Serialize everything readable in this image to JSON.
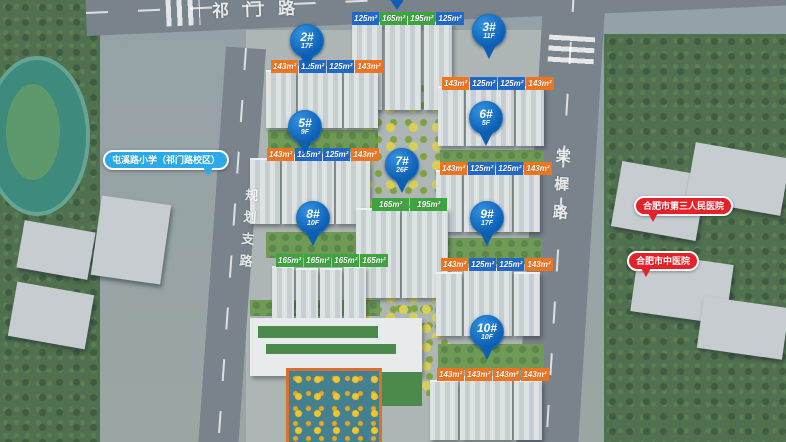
{
  "colors": {
    "pin": "#0d5fb4",
    "tag_blue": "#2268c8",
    "tag_orange": "#ef7420",
    "tag_green": "#3fa33f",
    "school_bubble": "#2ba9e8",
    "hospital_bubble": "#e62129"
  },
  "roads": {
    "top": "祁门路",
    "left": "规划支路",
    "right": "棠樨路"
  },
  "pois": {
    "school": {
      "label": "屯溪路小学（祁门路校区）"
    },
    "hospital1": {
      "label": "合肥市第三人民医院"
    },
    "hospital2": {
      "label": "合肥市中医院"
    }
  },
  "pins": [
    {
      "label": "2#",
      "floors": "17F"
    },
    {
      "label": "3#",
      "floors": "11F"
    },
    {
      "label": "5#",
      "floors": "9F"
    },
    {
      "label": "6#",
      "floors": "5F"
    },
    {
      "label": "7#",
      "floors": "26F"
    },
    {
      "label": "8#",
      "floors": "10F"
    },
    {
      "label": "9#",
      "floors": "17F"
    },
    {
      "label": "10#",
      "floors": "10F"
    }
  ],
  "unit_rows": [
    {
      "building": "1#",
      "tags": [
        {
          "v": "125m²",
          "c": "blue"
        },
        {
          "v": "165m²",
          "c": "green"
        },
        {
          "v": "195m²",
          "c": "green"
        },
        {
          "v": "125m²",
          "c": "blue"
        }
      ]
    },
    {
      "building": "2#",
      "tags": [
        {
          "v": "143m²",
          "c": "orange"
        },
        {
          "v": "125m²",
          "c": "blue"
        },
        {
          "v": "125m²",
          "c": "blue"
        },
        {
          "v": "143m²",
          "c": "orange"
        }
      ]
    },
    {
      "building": "3#",
      "tags": [
        {
          "v": "143m²",
          "c": "orange"
        },
        {
          "v": "125m²",
          "c": "blue"
        },
        {
          "v": "125m²",
          "c": "blue"
        },
        {
          "v": "143m²",
          "c": "orange"
        }
      ]
    },
    {
      "building": "5#",
      "tags": [
        {
          "v": "143m²",
          "c": "orange"
        },
        {
          "v": "125m²",
          "c": "blue"
        },
        {
          "v": "125m²",
          "c": "blue"
        },
        {
          "v": "143m²",
          "c": "orange"
        }
      ]
    },
    {
      "building": "6#",
      "tags": [
        {
          "v": "143m²",
          "c": "orange"
        },
        {
          "v": "125m²",
          "c": "blue"
        },
        {
          "v": "125m²",
          "c": "blue"
        },
        {
          "v": "143m²",
          "c": "orange"
        }
      ]
    },
    {
      "building": "7#",
      "tags": [
        {
          "v": "165m²",
          "c": "green"
        },
        {
          "v": "195m²",
          "c": "green"
        }
      ]
    },
    {
      "building": "8#",
      "tags": [
        {
          "v": "165m²",
          "c": "green"
        },
        {
          "v": "165m²",
          "c": "green"
        },
        {
          "v": "165m²",
          "c": "green"
        },
        {
          "v": "165m²",
          "c": "green"
        }
      ]
    },
    {
      "building": "9#",
      "tags": [
        {
          "v": "143m²",
          "c": "orange"
        },
        {
          "v": "125m²",
          "c": "blue"
        },
        {
          "v": "125m²",
          "c": "blue"
        },
        {
          "v": "143m²",
          "c": "orange"
        }
      ]
    },
    {
      "building": "10#",
      "tags": [
        {
          "v": "143m²",
          "c": "orange"
        },
        {
          "v": "143m²",
          "c": "orange"
        },
        {
          "v": "143m²",
          "c": "orange"
        },
        {
          "v": "143m²",
          "c": "orange"
        }
      ]
    }
  ]
}
